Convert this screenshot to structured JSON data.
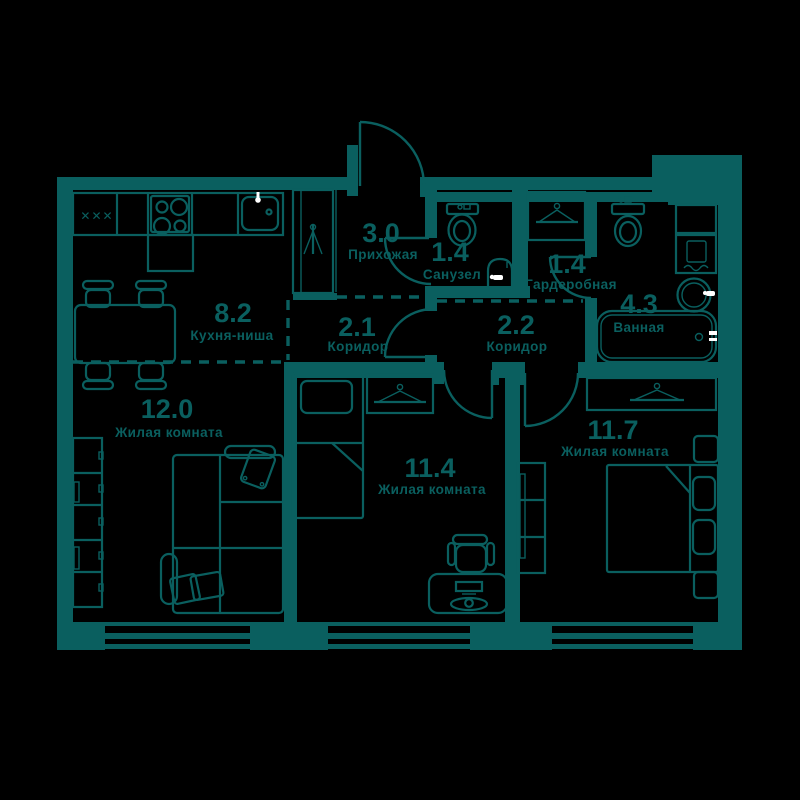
{
  "plan": {
    "background_color": "#000000",
    "line_color": "#0A5F5F",
    "accent_color": "#FFFFFF",
    "rooms": [
      {
        "key": "kitchen",
        "area": "8.2",
        "name": "Кухня-ниша"
      },
      {
        "key": "living-12",
        "area": "12.0",
        "name": "Жилая комната"
      },
      {
        "key": "hallway",
        "area": "3.0",
        "name": "Прихожая"
      },
      {
        "key": "wc",
        "area": "1.4",
        "name": "Санузел"
      },
      {
        "key": "corridor-1",
        "area": "2.1",
        "name": "Коридор"
      },
      {
        "key": "corridor-2",
        "area": "2.2",
        "name": "Коридор"
      },
      {
        "key": "wardrobe",
        "area": "1.4",
        "name": "Гардеробная"
      },
      {
        "key": "bathroom",
        "area": "4.3",
        "name": "Ванная"
      },
      {
        "key": "living-11-4",
        "area": "11.4",
        "name": "Жилая комната"
      },
      {
        "key": "living-11-7",
        "area": "11.7",
        "name": "Жилая комната"
      }
    ],
    "symbols": {
      "cooktop_marks": "✕✕✕"
    }
  }
}
